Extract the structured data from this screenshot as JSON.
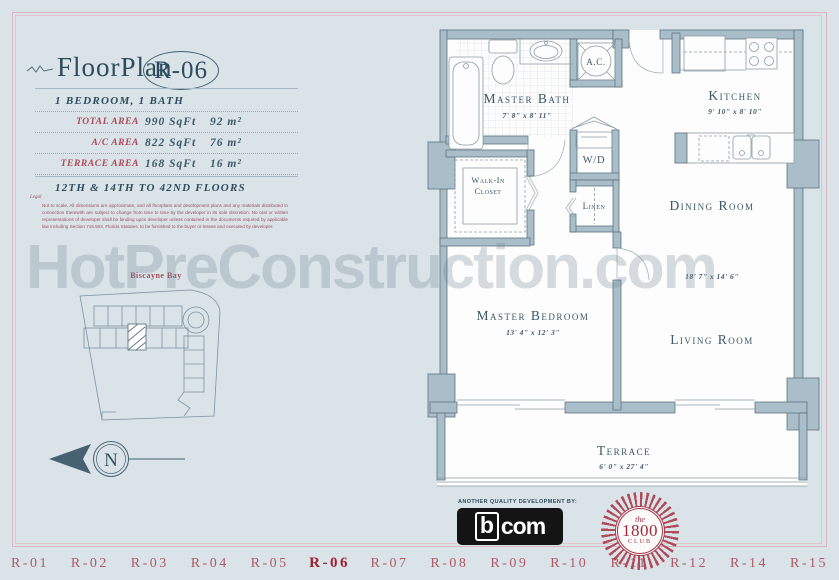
{
  "watermark": "HotPreConstruction.com",
  "sidebar": {
    "title_prefix": "FloorPlan",
    "title_unit": "R-06",
    "subtitle": "1 BEDROOM, 1 BATH",
    "area_rows": [
      {
        "label": "TOTAL AREA",
        "sqft": "990 SqFt",
        "metric": "92 m²"
      },
      {
        "label": "A/C AREA",
        "sqft": "822 SqFt",
        "metric": "76 m²"
      },
      {
        "label": "TERRACE AREA",
        "sqft": "168 SqFt",
        "metric": "16 m²"
      }
    ],
    "floors_note": "12TH & 14TH TO 42ND FLOORS",
    "legal_title": "Legal",
    "legal_text": "Not to scale. All dimensions are approximate, and all floorplans and development plans and any materials distributed in connection therewith are subject to change from time to time by the developer in its sole discretion. No oral or written representations of developer shall be binding upon developer unless contained in the documents required by applicable law including Section 718.503, Florida Statutes, to be furnished to the buyer or lessee and executed by developer.",
    "site_plan": {
      "bay_label": "Biscayne Bay"
    },
    "compass_label": "N"
  },
  "floorplan": {
    "master_bath": {
      "label": "Master Bath",
      "dims": "7' 8\" x 8' 11\""
    },
    "ac_label": "A.C.",
    "wd_label": "W/D",
    "linen_label": "Linen",
    "walk_in_line1": "Walk-In",
    "walk_in_line2": "Closet",
    "kitchen": {
      "label": "Kitchen",
      "dims": "9' 10\" x 8' 10\""
    },
    "dining_label": "Dining Room",
    "living_dims": "18' 7\" x 14' 6\"",
    "living_label": "Living Room",
    "master_bedroom": {
      "label": "Master Bedroom",
      "dims": "13' 4\" x 12' 3\""
    },
    "terrace": {
      "label": "Terrace",
      "dims": "6' 0\" x 27' 4\""
    }
  },
  "footer": {
    "dev_note": "ANOTHER QUALITY DEVELOPMENT BY:",
    "bcom_b": "b",
    "bcom_com": "com",
    "club_the": "the",
    "club_year": "1800",
    "club_name": "CLUB"
  },
  "nav": {
    "items": [
      {
        "label": "R-01",
        "active": false
      },
      {
        "label": "R-02",
        "active": false
      },
      {
        "label": "R-03",
        "active": false
      },
      {
        "label": "R-04",
        "active": false
      },
      {
        "label": "R-05",
        "active": false
      },
      {
        "label": "R-06",
        "active": true
      },
      {
        "label": "R-07",
        "active": false
      },
      {
        "label": "R-08",
        "active": false
      },
      {
        "label": "R-09",
        "active": false
      },
      {
        "label": "R-10",
        "active": false
      },
      {
        "label": "R-11",
        "active": false
      },
      {
        "label": "R-12",
        "active": false
      },
      {
        "label": "R-14",
        "active": false
      },
      {
        "label": "R-15",
        "active": false
      }
    ]
  },
  "colors": {
    "accent_red": "#9e2130",
    "label_red": "#ad4a59",
    "navy": "#2e4d5c",
    "wall": "#a9bec9",
    "background": "#d9e3e8"
  }
}
